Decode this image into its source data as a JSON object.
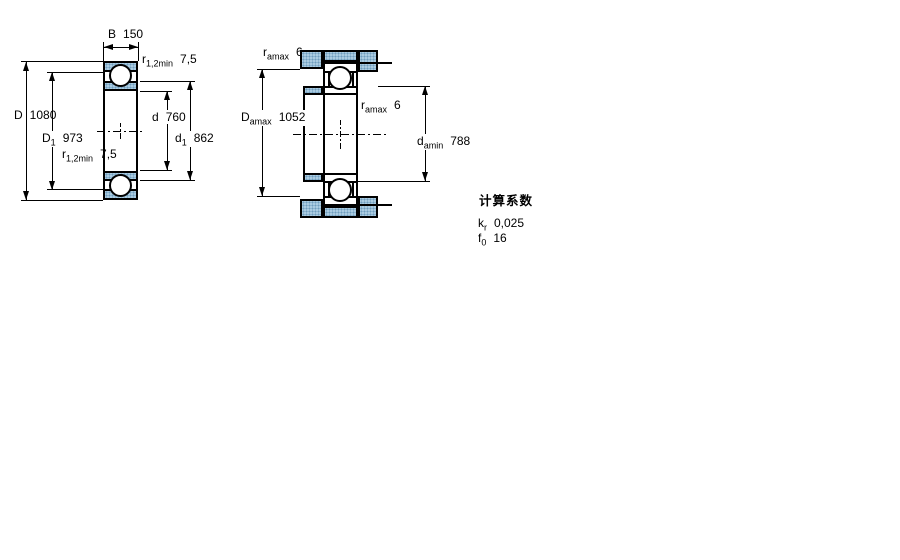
{
  "figure": {
    "type": "bearing-dimension-drawing",
    "left_view": {
      "labels": {
        "B": {
          "sym": "B",
          "val": "150"
        },
        "r_top": {
          "sym": "r",
          "sub": "1,2min",
          "val": "7,5"
        },
        "D": {
          "sym": "D",
          "val": "1080"
        },
        "D1": {
          "sym": "D",
          "sub": "1",
          "val": "973"
        },
        "r_bottom": {
          "sym": "r",
          "sub": "1,2min",
          "val": "7,5"
        },
        "d": {
          "sym": "d",
          "val": "760"
        },
        "d1": {
          "sym": "d",
          "sub": "1",
          "val": "862"
        }
      }
    },
    "right_view": {
      "labels": {
        "ra_top": {
          "sym": "r",
          "sub": "amax",
          "val": "6"
        },
        "Damax": {
          "sym": "D",
          "sub": "amax",
          "val": "1052"
        },
        "ra_mid": {
          "sym": "r",
          "sub": "amax",
          "val": "6"
        },
        "damin": {
          "sym": "d",
          "sub": "amin",
          "val": "788"
        }
      }
    },
    "calculation_factors": {
      "heading": "计算系数",
      "rows": [
        {
          "sym": "k",
          "sub": "r",
          "val": "0,025"
        },
        {
          "sym": "f",
          "sub": "0",
          "val": "16"
        }
      ]
    },
    "colors": {
      "hatch_fill": "#aacbe1",
      "hatch_dot": "#6f9cbd",
      "line": "#000000",
      "background": "#ffffff"
    }
  }
}
